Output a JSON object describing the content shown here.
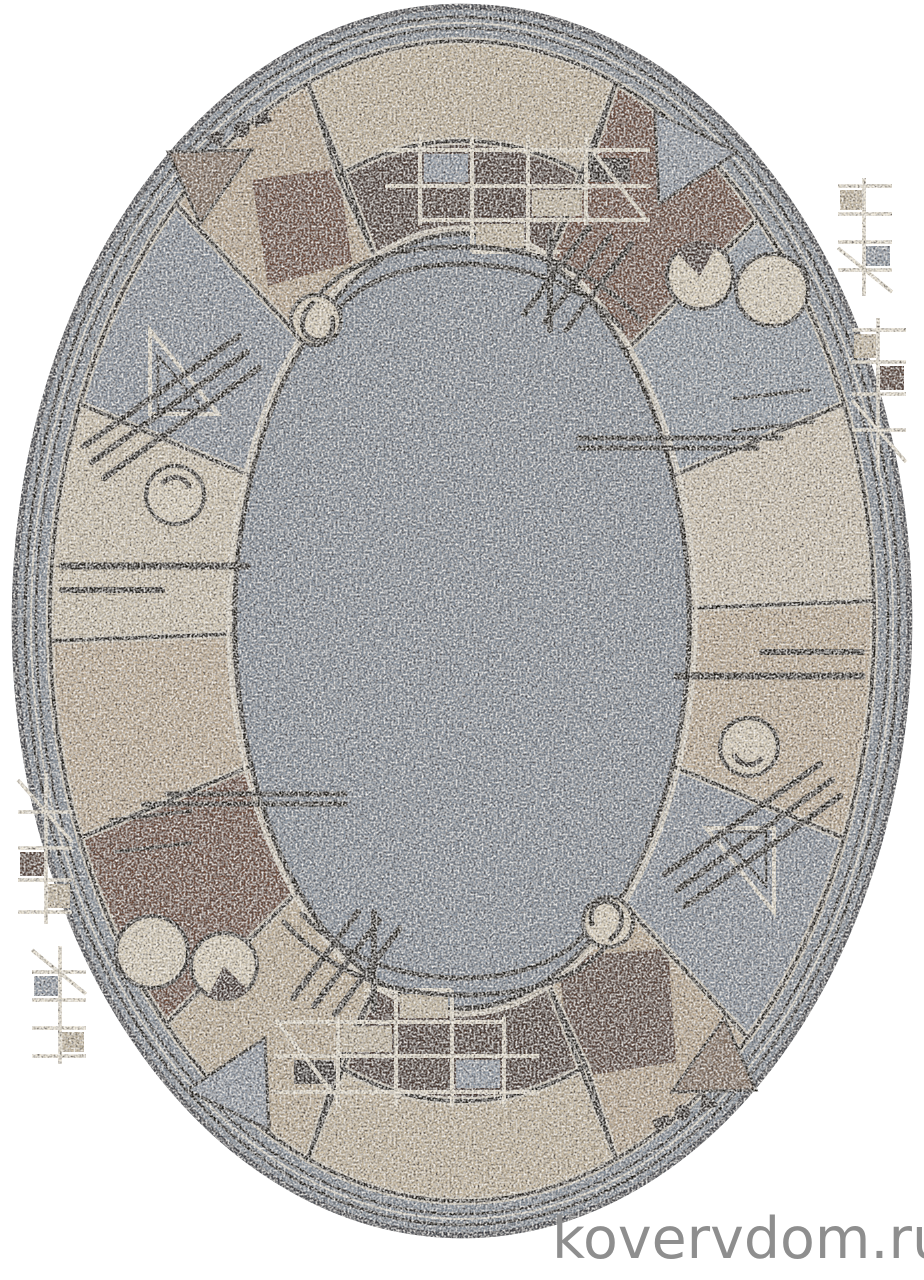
{
  "image": {
    "type": "product-photo",
    "description": "Oval pile carpet with speckled gray centre field and a geometric border of wedge segments in beige, cream, taupe and brown with circles, triangles, grids and line motifs",
    "background": "#FFFFFF"
  },
  "watermark": {
    "text": "kovervdom.ru",
    "color": "#8E8E8E"
  },
  "palette": {
    "field_gray": "#8A94A0",
    "binding_gray": "#8C96A1",
    "beige": "#C8B89E",
    "cream": "#D9CEBA",
    "taupe": "#B49C82",
    "brown": "#6F4C39",
    "dark_brown": "#4A342B",
    "outline_black": "#17130F",
    "line_white": "#EFE8D8"
  }
}
